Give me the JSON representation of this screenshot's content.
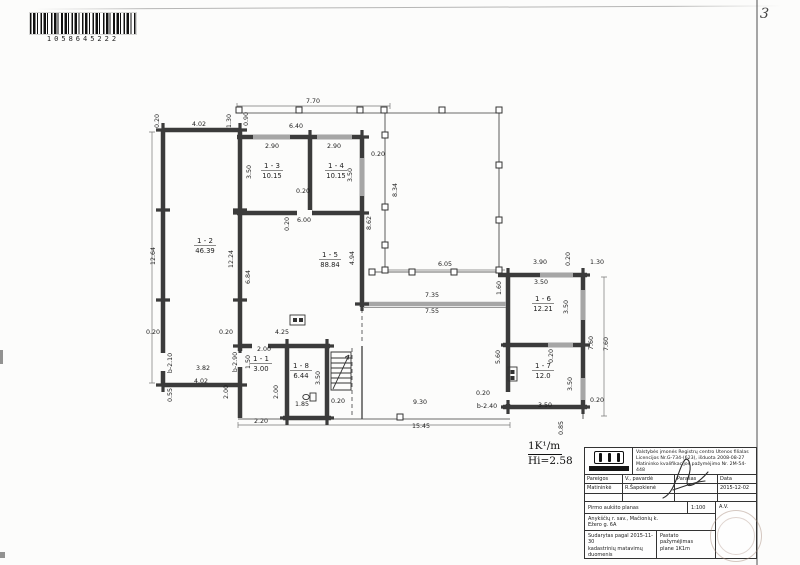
{
  "page": {
    "number": "3"
  },
  "barcode": {
    "number": "1058645222"
  },
  "note": {
    "top": "1K¹/m",
    "bottom": "Hi=2.58"
  },
  "colors": {
    "wall": "#3b3b3b",
    "window": "#a6a6a6",
    "stamp": "#a58778"
  },
  "plan": {
    "rooms": [
      {
        "id": "1 - 2",
        "area": "46.39",
        "x": 205,
        "y": 243
      },
      {
        "id": "1 - 3",
        "area": "10.15",
        "x": 272,
        "y": 168
      },
      {
        "id": "1 - 4",
        "area": "10.15",
        "x": 336,
        "y": 168
      },
      {
        "id": "1 - 5",
        "area": "88.84",
        "x": 330,
        "y": 257
      },
      {
        "id": "1 - 6",
        "area": "12.21",
        "x": 543,
        "y": 301
      },
      {
        "id": "1 - 7",
        "area": "12.0",
        "x": 543,
        "y": 368
      },
      {
        "id": "1 - 1",
        "area": "3.00",
        "x": 261,
        "y": 361
      },
      {
        "id": "1 - 8",
        "area": "6.44",
        "x": 301,
        "y": 368
      }
    ],
    "dimensions": [
      {
        "t": "7.70",
        "x": 313,
        "y": 103
      },
      {
        "t": "0.20",
        "x": 159,
        "y": 121,
        "v": 1
      },
      {
        "t": "4.02",
        "x": 199,
        "y": 126
      },
      {
        "t": "1.30",
        "x": 231,
        "y": 121,
        "v": 1
      },
      {
        "t": "0.90",
        "x": 248,
        "y": 119,
        "v": 1
      },
      {
        "t": "6.40",
        "x": 296,
        "y": 128
      },
      {
        "t": "2.90",
        "x": 272,
        "y": 148
      },
      {
        "t": "2.90",
        "x": 334,
        "y": 148
      },
      {
        "t": "0.20",
        "x": 378,
        "y": 156
      },
      {
        "t": "3.50",
        "x": 251,
        "y": 172,
        "v": 1
      },
      {
        "t": "3.50",
        "x": 352,
        "y": 175,
        "v": 1
      },
      {
        "t": "8.34",
        "x": 397,
        "y": 190,
        "v": 1
      },
      {
        "t": "0.20",
        "x": 303,
        "y": 193
      },
      {
        "t": "8.62",
        "x": 371,
        "y": 223,
        "v": 1
      },
      {
        "t": "0.20",
        "x": 289,
        "y": 224,
        "v": 1
      },
      {
        "t": "6.00",
        "x": 304,
        "y": 222
      },
      {
        "t": "4.94",
        "x": 354,
        "y": 258,
        "v": 1
      },
      {
        "t": "12.64",
        "x": 155,
        "y": 256,
        "v": 1
      },
      {
        "t": "12.24",
        "x": 233,
        "y": 259,
        "v": 1
      },
      {
        "t": "6.84",
        "x": 250,
        "y": 277,
        "v": 1
      },
      {
        "t": "6.05",
        "x": 445,
        "y": 266
      },
      {
        "t": "1.60",
        "x": 501,
        "y": 288,
        "v": 1
      },
      {
        "t": "7.35",
        "x": 432,
        "y": 297
      },
      {
        "t": "7.55",
        "x": 432,
        "y": 313
      },
      {
        "t": "3.90",
        "x": 540,
        "y": 264
      },
      {
        "t": "0.20",
        "x": 570,
        "y": 259,
        "v": 1
      },
      {
        "t": "1.30",
        "x": 597,
        "y": 264
      },
      {
        "t": "3.50",
        "x": 541,
        "y": 284
      },
      {
        "t": "3.50",
        "x": 568,
        "y": 307,
        "v": 1
      },
      {
        "t": "7.60",
        "x": 593,
        "y": 343,
        "v": 1
      },
      {
        "t": "7.60",
        "x": 608,
        "y": 344,
        "v": 1
      },
      {
        "t": "5.60",
        "x": 500,
        "y": 357,
        "v": 1
      },
      {
        "t": "0.20",
        "x": 553,
        "y": 356,
        "v": 1
      },
      {
        "t": "3.50",
        "x": 572,
        "y": 384,
        "v": 1
      },
      {
        "t": "0.20",
        "x": 153,
        "y": 334
      },
      {
        "t": "b-2.10",
        "x": 172,
        "y": 363,
        "v": 1
      },
      {
        "t": "3.82",
        "x": 203,
        "y": 370
      },
      {
        "t": "4.02",
        "x": 201,
        "y": 383
      },
      {
        "t": "0.55",
        "x": 172,
        "y": 395,
        "v": 1
      },
      {
        "t": "0.20",
        "x": 226,
        "y": 334
      },
      {
        "t": "4.25",
        "x": 282,
        "y": 334
      },
      {
        "t": "2.00",
        "x": 264,
        "y": 351
      },
      {
        "t": "1.50",
        "x": 250,
        "y": 362,
        "v": 1
      },
      {
        "t": "b-2.90",
        "x": 237,
        "y": 362,
        "v": 1
      },
      {
        "t": "2.00",
        "x": 228,
        "y": 392,
        "v": 1
      },
      {
        "t": "2.00",
        "x": 278,
        "y": 392,
        "v": 1
      },
      {
        "t": "3.50",
        "x": 320,
        "y": 378,
        "v": 1
      },
      {
        "t": "1.85",
        "x": 302,
        "y": 406
      },
      {
        "t": "0.20",
        "x": 338,
        "y": 403
      },
      {
        "t": "2.20",
        "x": 261,
        "y": 423
      },
      {
        "t": "9.30",
        "x": 420,
        "y": 404
      },
      {
        "t": "0.20",
        "x": 483,
        "y": 395
      },
      {
        "t": "b-2.40",
        "x": 487,
        "y": 408
      },
      {
        "t": "3.50",
        "x": 545,
        "y": 407
      },
      {
        "t": "0.20",
        "x": 597,
        "y": 402
      },
      {
        "t": "15.45",
        "x": 421,
        "y": 428
      },
      {
        "t": "0.85",
        "x": 563,
        "y": 428,
        "v": 1
      }
    ]
  },
  "titleblock": {
    "header1": "Valstybės įmonės Registrų centro Utenos filialas",
    "header2": "Licencijos Nr.G-734-(623), išduota 2008-08-27",
    "header3": "Matininko kvalifikacijos pažymėjimo Nr. 2M-54-448",
    "col1": "Pareigos",
    "col2": "V., pavardė",
    "col3": "Parašas",
    "col4": "Data",
    "pos": "Matininkė",
    "name": "R.Šapokienė",
    "date": "2015-12-02",
    "title": "Pirmo aukšto planas",
    "scale": "1:100",
    "av": "A.V.",
    "addr1": "Anykščių r. sav., Mačionių k.",
    "addr2": "Ežero g. 6A",
    "f_l1": "Sudarytas pagal 2015-11-30",
    "f_l2": "kadastrinių matavimų duomenis",
    "f_r1": "Pastato pažymėjimas",
    "f_r2": "plane   1K1m"
  }
}
